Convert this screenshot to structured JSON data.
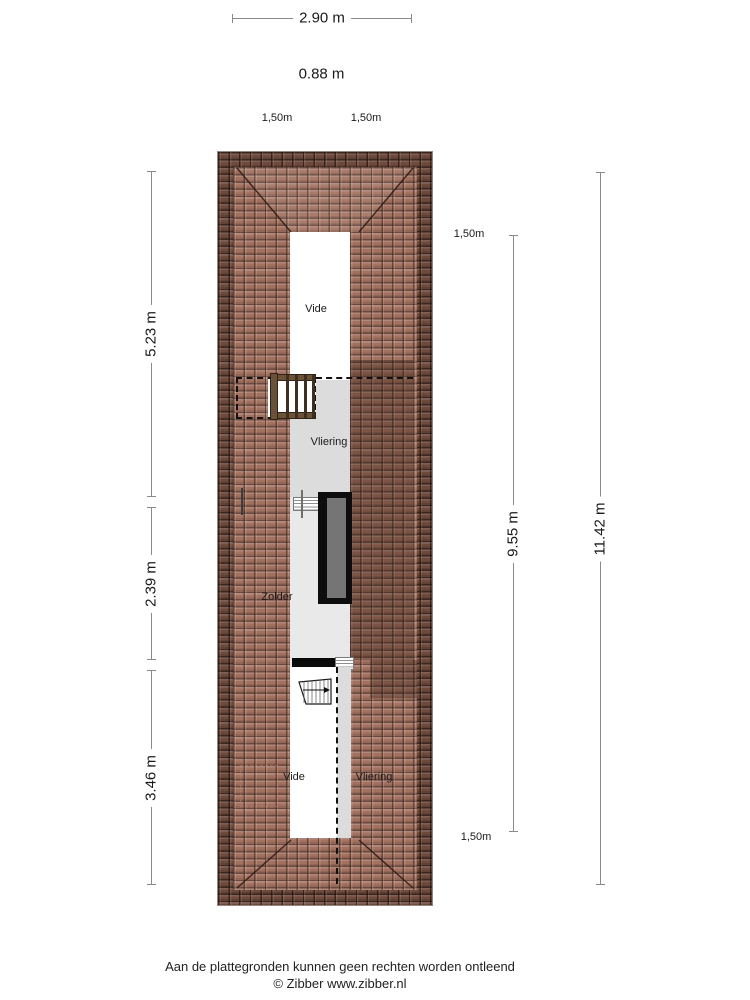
{
  "plan": {
    "rooms": {
      "vide_top": "Vide",
      "vliering_top": "Vliering",
      "zolder": "Zolder",
      "vide_bottom": "Vide",
      "vliering_bottom": "Vliering"
    }
  },
  "dimensions": {
    "top_width": "2.90 m",
    "top_ridge": "0.88 m",
    "top_left_clearance": "1,50m",
    "top_right_clearance": "1,50m",
    "left_upper": "5.23 m",
    "left_middle": "2.39 m",
    "left_lower": "3.46 m",
    "right_clearance_top": "1,50m",
    "right_inner": "9.55 m",
    "right_outer": "11.42 m",
    "right_clearance_bottom": "1,50m"
  },
  "footer": {
    "disclaimer": "Aan de plattegronden kunnen geen rechten worden ontleend",
    "copyright": "© Zibber www.zibber.nl"
  },
  "colors": {
    "roof_tile_light": "#a27160",
    "roof_tile_dark": "#6e4a3c",
    "floor_gray": "#dcdcdc",
    "corridor_gray": "#e9e9e9",
    "roof_window_fill": "#757575"
  }
}
